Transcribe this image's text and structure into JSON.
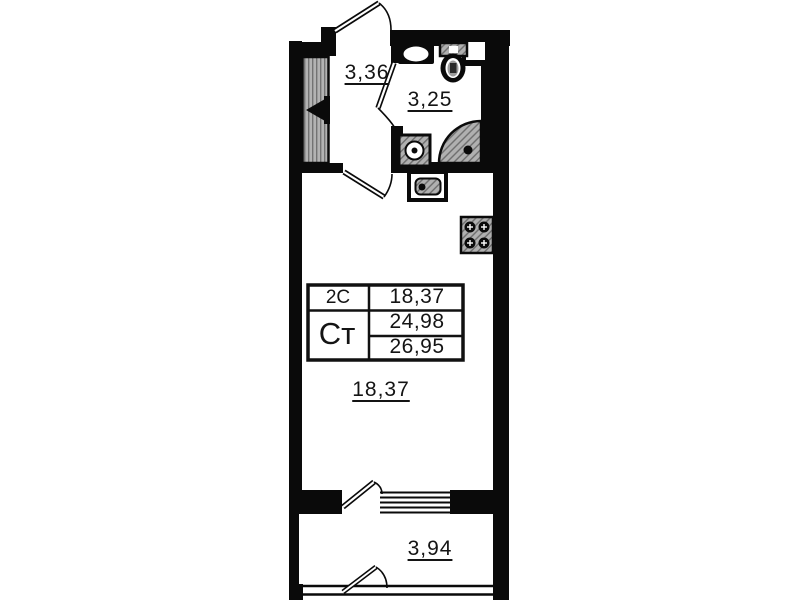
{
  "rooms": {
    "hall": {
      "area": "3,36"
    },
    "bathroom": {
      "area": "3,25"
    },
    "living_room": {
      "area": "18,37"
    },
    "balcony": {
      "area": "3,94"
    }
  },
  "stamp": {
    "type_code": "2С",
    "type_label": "Ст",
    "living_area": "18,37",
    "area_excl_balcony": "24,98",
    "total_area": "26,95"
  },
  "symbols": {
    "wardrobe-shaft": "hatched-rectangle-with-valve-triangle",
    "washbasin": "oval-in-counter",
    "toilet": "cistern-and-bowl",
    "shower": "quarter-circle-hatch-with-drain",
    "washing-machine": "square-with-porthole-circle",
    "kitchen-sink": "rounded-square-in-counter",
    "stove": "four-burner-square",
    "door-swing": "leaf-line-with-arc",
    "window": "parallel-lines"
  },
  "colors": {
    "wall": "#0a0a0a",
    "text": "#141414",
    "hatch_fill": "#b3b3b3",
    "hatch_line": "#737373",
    "background": "#ffffff"
  }
}
